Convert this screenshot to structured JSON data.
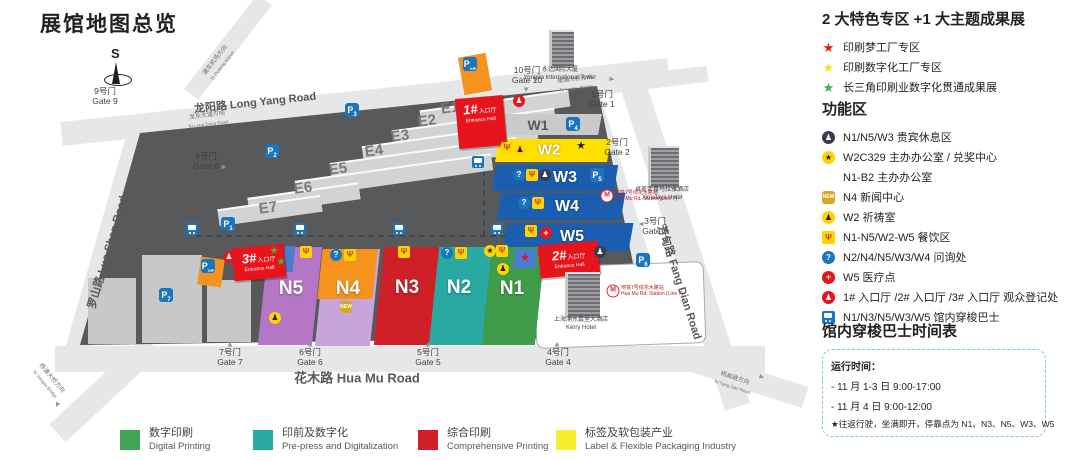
{
  "page_title": "展馆地图总览",
  "compass_label": "S",
  "features_panel": {
    "title": "2 大特色专区 +1 大主题成果展",
    "items": [
      {
        "star": "#e8141c",
        "label": "印刷梦工厂专区"
      },
      {
        "star": "#f3e524",
        "label": "印刷数字化工厂专区"
      },
      {
        "star": "#3cb54a",
        "label": "长三角印刷业数字化贯通成果展"
      }
    ]
  },
  "functions_panel": {
    "title": "功能区",
    "items": [
      {
        "icon": "person-dark",
        "glyph": "♟",
        "label": "N1/N5/W3 贵宾休息区"
      },
      {
        "icon": "star-circle",
        "glyph": "★",
        "label": "W2C329 主办办公室 / 兑奖中心"
      },
      {
        "icon": "none",
        "glyph": "",
        "label": "N1-B2 主办办公室"
      },
      {
        "icon": "new",
        "glyph": "NEW",
        "label": "N4 新闻中心"
      },
      {
        "icon": "person-yellow",
        "glyph": "♟",
        "label": "W2 祈祷室"
      },
      {
        "icon": "utensils",
        "glyph": "Ψ",
        "label": "N1-N5/W2-W5 餐饮区"
      },
      {
        "icon": "question",
        "glyph": "?",
        "label": "N2/N4/N5/W3/W4 问询处"
      },
      {
        "icon": "medical",
        "glyph": "+",
        "label": "W5 医疗点"
      },
      {
        "icon": "person-red",
        "glyph": "♟",
        "label": "1# 入口厅 /2# 入口厅 /3# 入口厅 观众登记处"
      },
      {
        "icon": "bus",
        "glyph": "",
        "label": "N1/N3/N5/W3/W5 馆内穿梭巴士"
      }
    ]
  },
  "shuttle_panel": {
    "title": "馆内穿梭巴士时间表",
    "lines": [
      "运行时间：",
      "- 11 月 1-3 日 9:00-17:00",
      "- 11 月 4 日 9:00-12:00",
      "★往返行驶，坐满即开，停靠点为 N1、N3、N5、W3、W5"
    ]
  },
  "legend": {
    "items": [
      {
        "color": "#43a356",
        "cn": "数字印刷",
        "en": "Digital Printing",
        "x": 120
      },
      {
        "color": "#2aa8a2",
        "cn": "印前及数字化",
        "en": "Pre-press and Digitalization",
        "x": 253
      },
      {
        "color": "#d01f26",
        "cn": "综合印刷",
        "en": "Comprehensive Printing",
        "x": 418
      },
      {
        "color": "#f9ed32",
        "cn": "标签及软包装产业",
        "en": "Label & Flexible Packaging Industry",
        "x": 556
      }
    ]
  },
  "map": {
    "venue_polygon": "140px 133px, 597px 86px, 648px 337px, 80px 345px",
    "kerry_cutout": {
      "x": 535,
      "y": 264,
      "w": 168,
      "h": 80,
      "rot": -2
    },
    "roads": [
      {
        "x": 60,
        "y": 90,
        "w": 610,
        "h": 24,
        "rot": -6
      },
      {
        "x": 168,
        "y": 38,
        "w": 120,
        "h": 18,
        "rot": -52
      },
      {
        "x": -15,
        "y": 226,
        "w": 250,
        "h": 26,
        "rot": 106
      },
      {
        "x": 55,
        "y": 346,
        "w": 710,
        "h": 26,
        "rot": 0
      },
      {
        "x": 492,
        "y": 202,
        "w": 260,
        "h": 30,
        "rot": 73
      },
      {
        "x": 515,
        "y": 232,
        "w": 340,
        "h": 26,
        "rot": 72
      },
      {
        "x": 588,
        "y": 73,
        "w": 120,
        "h": 16,
        "rot": -7
      },
      {
        "x": 40,
        "y": 377,
        "w": 130,
        "h": 24,
        "rot": 137
      },
      {
        "x": 688,
        "y": 368,
        "w": 120,
        "h": 22,
        "rot": 18
      }
    ],
    "road_labels": [
      {
        "text": "龙阳路 Long Yang Road",
        "x": 255,
        "y": 102,
        "rot": -6,
        "size": 11
      },
      {
        "text": "罗山路 Luo Shan Road",
        "x": 107,
        "y": 252,
        "rot": -74,
        "size": 11
      },
      {
        "text": "花木路 Hua Mu Road",
        "x": 357,
        "y": 377,
        "rot": 0,
        "size": 13
      },
      {
        "text": "芳甸路 Fang Dian Road",
        "x": 680,
        "y": 282,
        "rot": 72,
        "size": 11
      }
    ],
    "direction_labels": [
      {
        "cn": "浦东机场方向",
        "en": "To Pudong Airport",
        "x": 215,
        "y": 60,
        "rot": -52
      },
      {
        "cn": "龙东大道方向",
        "en": "To Long Dong Road",
        "x": 207,
        "y": 115,
        "rot": -7
      },
      {
        "cn": "南浦大桥方向",
        "en": "To Nanpu Bridge",
        "x": 575,
        "y": 79,
        "rot": -7
      },
      {
        "cn": "杨浦大桥方向",
        "en": "To Yangpu Bridge",
        "x": 52,
        "y": 378,
        "rot": 50
      },
      {
        "cn": "杨高路方向",
        "en": "To Yang Gao Road",
        "x": 735,
        "y": 378,
        "rot": 18
      }
    ],
    "gray_blocks": [
      {
        "x": 142,
        "y": 255,
        "w": 60,
        "h": 88,
        "rot": 0
      },
      {
        "x": 88,
        "y": 278,
        "w": 48,
        "h": 66,
        "rot": 0
      },
      {
        "x": 207,
        "y": 280,
        "w": 44,
        "h": 62,
        "rot": 0
      }
    ],
    "halls_e": [
      {
        "id": "E1",
        "x": 420,
        "y": 100,
        "w": 150,
        "lx": 450,
        "ly": 108
      },
      {
        "id": "E2",
        "x": 392,
        "y": 119,
        "w": 164,
        "lx": 427,
        "ly": 121
      },
      {
        "id": "E3",
        "x": 362,
        "y": 134,
        "w": 176,
        "lx": 400,
        "ly": 136
      },
      {
        "id": "E4",
        "x": 330,
        "y": 150,
        "w": 188,
        "lx": 374,
        "ly": 151
      },
      {
        "id": "E5",
        "x": 295,
        "y": 167,
        "w": 198,
        "lx": 338,
        "ly": 169
      },
      {
        "id": "E6",
        "x": 248,
        "y": 190,
        "w": 112,
        "lx": 303,
        "ly": 188
      },
      {
        "id": "E7",
        "x": 218,
        "y": 202,
        "w": 104,
        "lx": 268,
        "ly": 208
      }
    ],
    "halls_w": [
      {
        "id": "W1",
        "x": 500,
        "y": 114,
        "w": 100,
        "h": 21,
        "color": "#c8cacc",
        "lx": 538,
        "ly": 125,
        "lc": "#58595b",
        "ls": 14
      },
      {
        "id": "W2",
        "x": 497,
        "y": 139,
        "w": 112,
        "h": 23,
        "color": "#ffe100",
        "lx": 549,
        "ly": 150,
        "lc": "#ffffff",
        "ls": 15
      },
      {
        "id": "W3",
        "x": 494,
        "y": 165,
        "w": 122,
        "h": 26,
        "color": "#1b5daf",
        "lx": 565,
        "ly": 178,
        "lc": "#ffffff",
        "ls": 16
      },
      {
        "id": "W4",
        "x": 499,
        "y": 193,
        "w": 124,
        "h": 27,
        "color": "#1b5daf",
        "lx": 567,
        "ly": 207,
        "lc": "#ffffff",
        "ls": 16
      },
      {
        "id": "W5",
        "x": 505,
        "y": 223,
        "w": 126,
        "h": 28,
        "color": "#1b5daf",
        "lx": 572,
        "ly": 237,
        "lc": "#ffffff",
        "ls": 16
      }
    ],
    "halls_n": [
      {
        "id": "N5",
        "x": 263,
        "y": 247,
        "w": 54,
        "h": 98,
        "color": "#b577c5",
        "lx": 291,
        "ly": 289
      },
      {
        "id": "N4",
        "x": 320,
        "y": 249,
        "w": 55,
        "h": 97,
        "color": "#c9a3dc",
        "lx": 348,
        "ly": 289
      },
      {
        "id": "N3",
        "x": 379,
        "y": 247,
        "w": 56,
        "h": 98,
        "color": "#cf2027",
        "lx": 407,
        "ly": 288
      },
      {
        "id": "N2",
        "x": 434,
        "y": 247,
        "w": 53,
        "h": 98,
        "color": "#2aa8a2",
        "lx": 459,
        "ly": 288
      },
      {
        "id": "N1",
        "x": 487,
        "y": 247,
        "w": 53,
        "h": 98,
        "color": "#3f9c49",
        "lx": 512,
        "ly": 289
      }
    ],
    "n4_orange": {
      "x": 320,
      "y": 249,
      "w": 55,
      "h": 50,
      "color": "#f6921e"
    },
    "star_panels": [
      {
        "x": 266,
        "y": 246,
        "w": 28,
        "h": 26,
        "color": "#4a7bd0"
      },
      {
        "x": 514,
        "y": 249,
        "w": 22,
        "h": 19,
        "color": "#4a7bd0"
      }
    ],
    "entrances": [
      {
        "num": "1#",
        "cn": "入口厅",
        "en": "Entrance Hall",
        "x": 457,
        "y": 97,
        "w": 48,
        "h": 47
      },
      {
        "num": "2#",
        "cn": "入口厅",
        "en": "Entrance Hall",
        "x": 539,
        "y": 243,
        "w": 60,
        "h": 30
      },
      {
        "num": "3#",
        "cn": "入口厅",
        "en": "Entrance Hall",
        "x": 233,
        "y": 246,
        "w": 52,
        "h": 30
      }
    ],
    "icons": [
      {
        "t": "star",
        "c": "#3cb54a",
        "x": 274,
        "y": 251
      },
      {
        "t": "star",
        "c": "#3cb54a",
        "x": 281,
        "y": 262
      },
      {
        "t": "utensils",
        "x": 306,
        "y": 252
      },
      {
        "t": "person-yellow",
        "x": 275,
        "y": 318
      },
      {
        "t": "question",
        "x": 336,
        "y": 255
      },
      {
        "t": "utensils",
        "x": 350,
        "y": 255
      },
      {
        "t": "new",
        "x": 346,
        "y": 307
      },
      {
        "t": "utensils",
        "x": 404,
        "y": 252
      },
      {
        "t": "question",
        "x": 447,
        "y": 253
      },
      {
        "t": "utensils",
        "x": 461,
        "y": 253
      },
      {
        "t": "star-circle",
        "x": 490,
        "y": 251
      },
      {
        "t": "utensils",
        "x": 502,
        "y": 251
      },
      {
        "t": "person-yellow",
        "x": 503,
        "y": 269
      },
      {
        "t": "star",
        "c": "#e8141c",
        "x": 525,
        "y": 258
      },
      {
        "t": "utensils",
        "x": 507,
        "y": 148
      },
      {
        "t": "person-yellow",
        "x": 520,
        "y": 150
      },
      {
        "t": "star",
        "c": "#231f20",
        "x": 581,
        "y": 146
      },
      {
        "t": "question",
        "x": 519,
        "y": 175
      },
      {
        "t": "utensils",
        "x": 532,
        "y": 175
      },
      {
        "t": "person-dark",
        "x": 545,
        "y": 175
      },
      {
        "t": "question",
        "x": 524,
        "y": 203
      },
      {
        "t": "utensils",
        "x": 538,
        "y": 203
      },
      {
        "t": "utensils",
        "x": 531,
        "y": 231
      },
      {
        "t": "medical",
        "x": 546,
        "y": 233
      },
      {
        "t": "person-red",
        "x": 519,
        "y": 101
      },
      {
        "t": "person-dark",
        "x": 600,
        "y": 252
      },
      {
        "t": "person-red",
        "x": 229,
        "y": 257
      }
    ],
    "parkings": [
      {
        "n": "3",
        "x": 352,
        "y": 110
      },
      {
        "n": "2",
        "x": 272,
        "y": 151
      },
      {
        "n": "1",
        "x": 228,
        "y": 224
      },
      {
        "n": "7",
        "x": 166,
        "y": 295
      },
      {
        "n": "4",
        "x": 573,
        "y": 124
      },
      {
        "n": "5",
        "x": 597,
        "y": 175
      },
      {
        "n": "6",
        "x": 643,
        "y": 260
      },
      {
        "n": "VIP",
        "x": 470,
        "y": 64
      },
      {
        "n": "VIP",
        "x": 208,
        "y": 266
      }
    ],
    "vip_backs": [
      {
        "x": 461,
        "y": 55,
        "w": 28,
        "h": 38,
        "rot": -10
      },
      {
        "x": 199,
        "y": 258,
        "w": 24,
        "h": 28,
        "rot": 8
      }
    ],
    "bus_icons": [
      [
        192,
        229
      ],
      [
        300,
        229
      ],
      [
        399,
        229
      ],
      [
        497,
        229
      ],
      [
        478,
        162
      ]
    ],
    "dashes": [
      {
        "dir": "h",
        "x": 196,
        "y": 235,
        "len": 310
      },
      {
        "dir": "v",
        "x": 483,
        "y": 160,
        "len": 76
      }
    ],
    "gates": [
      {
        "cn": "1号门",
        "en": "Gate 1",
        "x": 602,
        "y": 100
      },
      {
        "cn": "2号门",
        "en": "Gate 2",
        "x": 617,
        "y": 148
      },
      {
        "cn": "3号门",
        "en": "Gate 3",
        "x": 655,
        "y": 227
      },
      {
        "cn": "4号门",
        "en": "Gate 4",
        "x": 558,
        "y": 358
      },
      {
        "cn": "5号门",
        "en": "Gate 5",
        "x": 428,
        "y": 358
      },
      {
        "cn": "6号门",
        "en": "Gate 6",
        "x": 310,
        "y": 358
      },
      {
        "cn": "7号门",
        "en": "Gate 7",
        "x": 230,
        "y": 358
      },
      {
        "cn": "8号门",
        "en": "Gate 8",
        "x": 206,
        "y": 162
      },
      {
        "cn": "9号门",
        "en": "Gate 9",
        "x": 105,
        "y": 97
      },
      {
        "cn": "10号门",
        "en": "Gate 10",
        "x": 527,
        "y": 76
      }
    ],
    "gate_arrows": [
      {
        "x": 230,
        "y": 344,
        "rot": 0
      },
      {
        "x": 310,
        "y": 344,
        "rot": 0
      },
      {
        "x": 428,
        "y": 344,
        "rot": 0
      },
      {
        "x": 557,
        "y": 344,
        "rot": 0
      },
      {
        "x": 526,
        "y": 90,
        "rot": 180
      },
      {
        "x": 641,
        "y": 224,
        "rot": -90
      },
      {
        "x": 224,
        "y": 167,
        "rot": 90
      },
      {
        "x": 612,
        "y": 79,
        "rot": 95
      },
      {
        "x": 57,
        "y": 405,
        "rot": 205
      },
      {
        "x": 762,
        "y": 377,
        "rot": 110
      }
    ],
    "buildings": [
      {
        "cn": "永达国际大厦",
        "en": "Yongda International Tower",
        "x": 549,
        "y": 30,
        "w": 22,
        "h": 36
      },
      {
        "cn": "卓美亚喜马拉雅酒店",
        "en": "Ximalaya Hotel",
        "x": 648,
        "y": 146,
        "w": 28,
        "h": 40
      },
      {
        "cn": "上海浦东嘉里大酒店",
        "en": "Kerry Hotel",
        "x": 565,
        "y": 272,
        "w": 32,
        "h": 44
      }
    ],
    "metro_stations": [
      {
        "cn": "地铁7号线花木路站",
        "en": "Hua Mu Rd. Station (Line 7)",
        "x": 607,
        "y": 196
      },
      {
        "cn": "地铁7号线花木路站",
        "en": "Hua Mu Rd. Station (Line 7)",
        "x": 613,
        "y": 291
      }
    ],
    "compass": {
      "x": 104,
      "y": 46
    }
  }
}
